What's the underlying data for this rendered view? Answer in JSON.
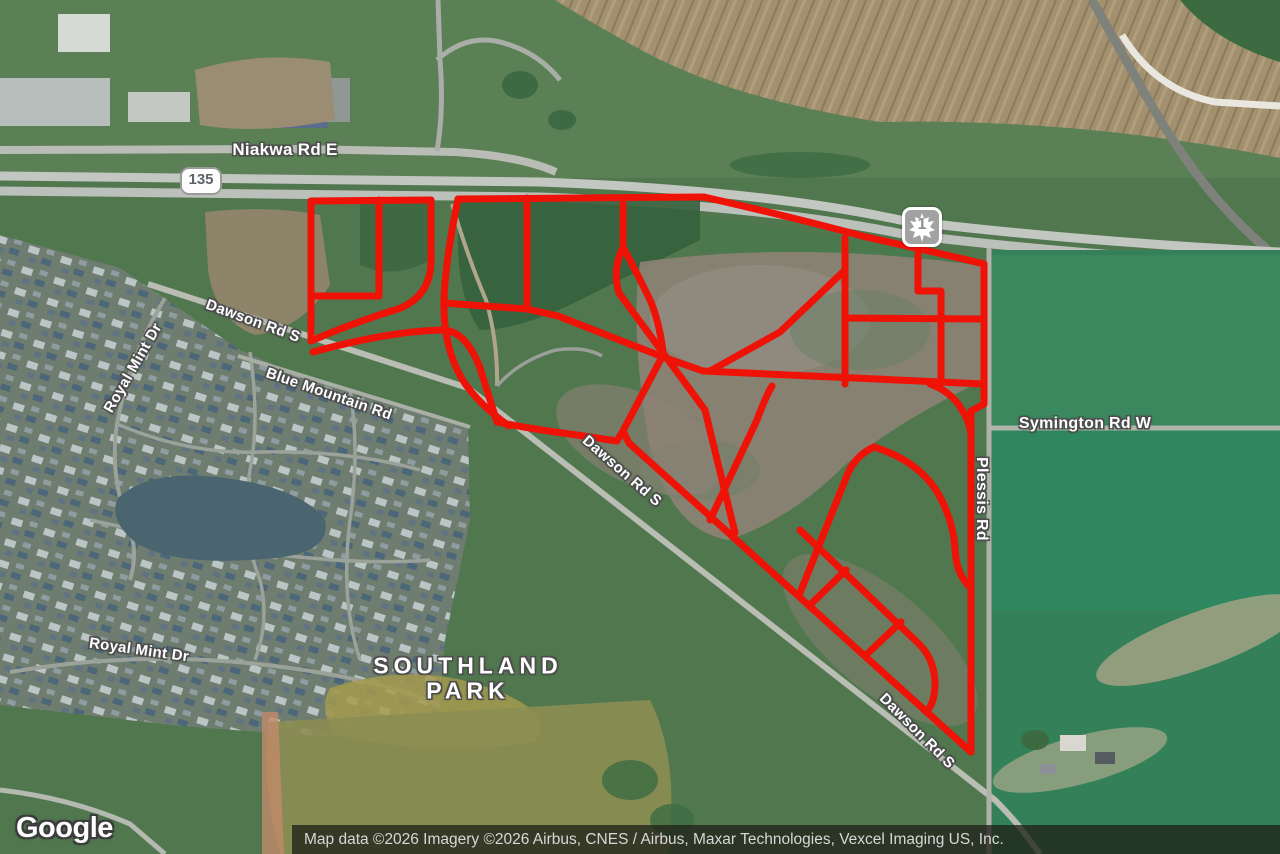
{
  "map": {
    "labels": {
      "niakwa": "Niakwa Rd E",
      "dawson_1": "Dawson Rd S",
      "dawson_2": "Dawson Rd S",
      "dawson_3": "Dawson Rd S",
      "royal_mint_1": "Royal Mint Dr",
      "royal_mint_2": "Royal Mint Dr",
      "blue_mountain": "Blue Mountain Rd",
      "symington": "Symington Rd W",
      "plessis": "Plessis Rd",
      "southland_line1": "SOUTHLAND",
      "southland_line2": "PARK"
    },
    "shields": {
      "provincial_route": "135",
      "trans_canada_route": "1"
    },
    "overlay": {
      "color": "#ee1207",
      "stroke_width": "7"
    },
    "branding": {
      "logo_text": "Google"
    },
    "attribution": {
      "text": "Map data ©2026 Imagery ©2026 Airbus, CNES / Airbus, Maxar Technologies, Vexcel Imaging US, Inc."
    }
  }
}
